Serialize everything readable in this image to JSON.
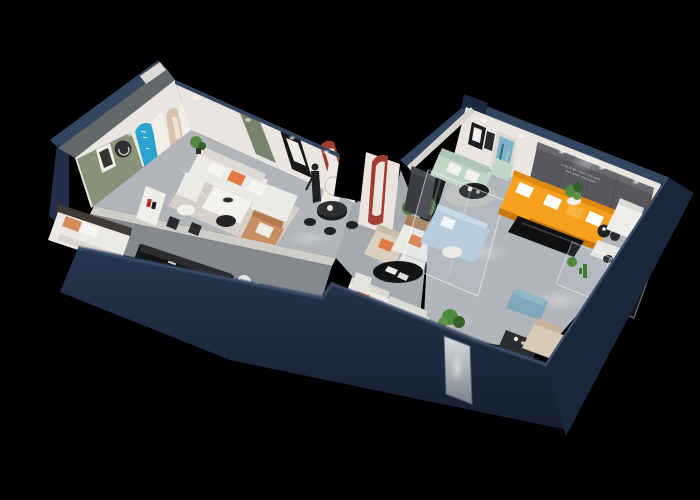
{
  "scene": {
    "description": "3D isometric cutaway render of a furniture showroom floor plan on a black background, dark navy exterior walls, lit gray floors",
    "background": "#000000",
    "wall_slogan": {
      "line1": "LIFE IS NOT WHAT YOU HAVE",
      "line2": "BUT WHAT YOU ENJOY"
    },
    "areas": [
      "green-accent lounge with arched display wall",
      "hall with white sectional and dining table",
      "front bedroom with bed and black console",
      "connecting corridor with black dining set and statue",
      "main living room with orange sectional and media wall",
      "glass display boxes with show beds and plants"
    ],
    "furniture": [
      "white sectional sofa",
      "white dining table",
      "tan armchair",
      "terracotta bed pillows",
      "black console",
      "blue arch display",
      "arched poster niches",
      "green door",
      "red arch niche",
      "mannequin statue",
      "black round dining table",
      "red arch pillar",
      "potted tree",
      "beige armchair",
      "white sofa with orange pillows",
      "mint sofa set",
      "blue abstract painting",
      "dark media wall",
      "orange sectional sofa",
      "black media bench",
      "white armchair",
      "teddy bear",
      "glass display box",
      "blue tufted daybed",
      "blue ottoman",
      "beige recliner",
      "black oval coffee table",
      "pedestal plant",
      "mirror door"
    ]
  },
  "palette": {
    "bg": "#000000",
    "navyTop": "#33465f",
    "navyBand": "#2b3d56",
    "navyFace": "#222f49",
    "navyFaceDark": "#1a2639",
    "wallWhite": "#e9e6e1",
    "wallShade": "#d8d5d0",
    "grayOuter": "#62676a",
    "floorMain": "#b2b5b9",
    "floorLight": "#c7c9cc",
    "floorDark": "#85898e",
    "rugCream": "#d7d2c8",
    "sageGreen": "#8a9379",
    "doorGreen": "#77836d",
    "arcBlue": "#2ba4cd",
    "accentRed": "#a23d34",
    "orange": "#f5a11f",
    "orangeDark": "#e18a10",
    "orangePillow": "#e07a42",
    "mint": "#c2d6c8",
    "glassBlue": "#b7cddd",
    "tvWall": "#58585c",
    "charcoal": "#3b3b40",
    "plantGreen": "#4f8a3e",
    "plantDark": "#355f2b",
    "woodTan": "#a87f5e",
    "teddyBrown": "#7b4a2b",
    "beige": "#d8cab4",
    "sofaWhite": "#eceae6",
    "blackFurn": "#131416"
  }
}
